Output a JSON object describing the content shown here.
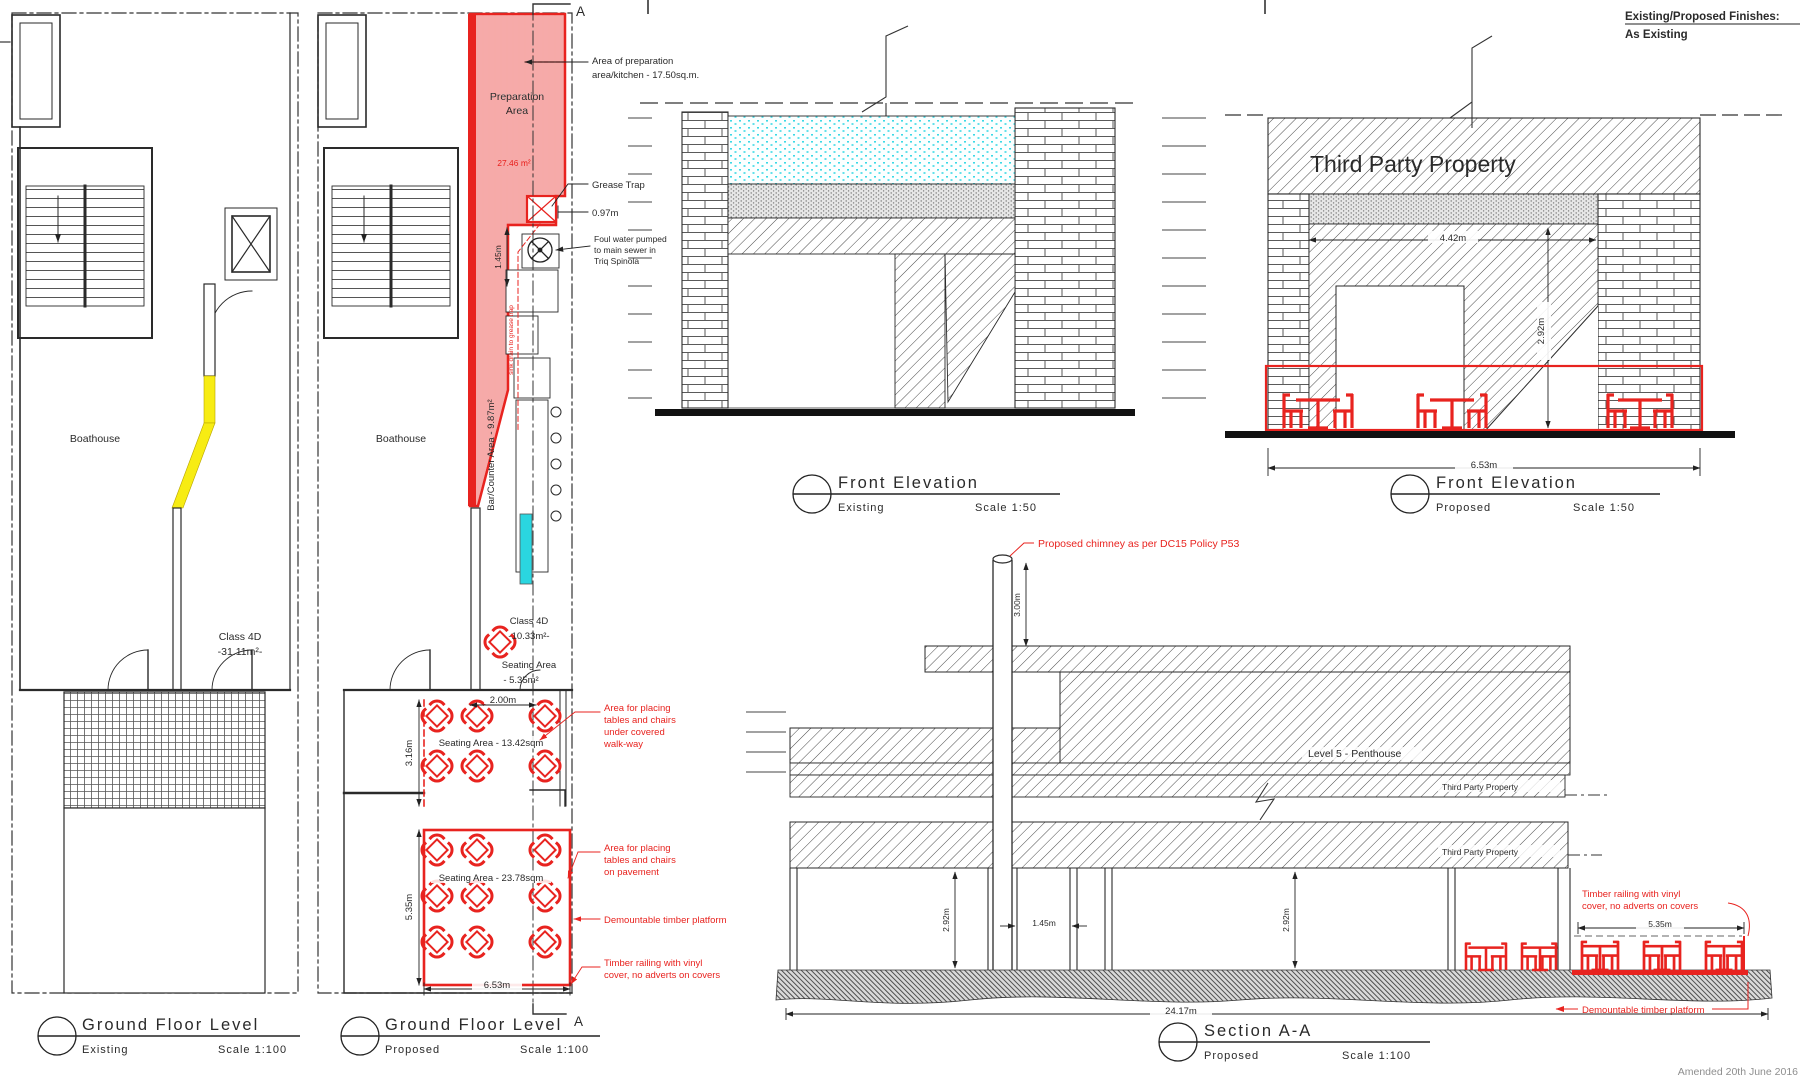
{
  "sheet": {
    "a_top": "A",
    "a_bottom": "A",
    "finishes_title": "Existing/Proposed  Finishes:",
    "finishes_value": "As  Existing",
    "amended": "Amended 20th June 2016",
    "accent_color": "#e8231f",
    "highlight_color": "#f7ec13",
    "counter_color": "#2ad6e0"
  },
  "plan_ex": {
    "boathouse": "Boathouse",
    "class4d": [
      "Class 4D",
      "-31.11m²-"
    ],
    "title": "Ground  Floor  Level",
    "sub": "Existing",
    "scale": "Scale  1:100"
  },
  "plan_pr": {
    "boathouse": "Boathouse",
    "prep": [
      "Preparation",
      "Area"
    ],
    "prep_area": "27.46 m²",
    "ann_prep": [
      "Area of preparation",
      "area/kitchen - 17.50sq.m."
    ],
    "grease": "Grease Trap",
    "d097": "0.97m",
    "foul": [
      "Foul water pumped",
      "to main sewer in",
      "Triq Spinola"
    ],
    "d145": "1.45m",
    "drain": "sink drain to grease trap",
    "bar": "Bar/Counter Area - 9.87m²",
    "class4d": [
      "Class 4D",
      "-10.33m²-"
    ],
    "seat_in": [
      "Seating Area",
      "- 5.35m²"
    ],
    "d200": "2.00m",
    "d316": "3.16m",
    "seat_walk": "Seating Area - 13.42sqm",
    "d535": "5.35m",
    "seat_pave": "Seating Area - 23.78sqm",
    "d653": "6.53m",
    "ann_walk": [
      "Area for placing",
      "tables and chairs",
      "under covered",
      "walk-way"
    ],
    "ann_pave": [
      "Area for placing",
      "tables and chairs",
      "on pavement"
    ],
    "ann_platform": "Demountable timber platform",
    "ann_rail": [
      "Timber railing with vinyl",
      "cover, no adverts on covers"
    ],
    "title": "Ground  Floor  Level",
    "sub": "Proposed",
    "scale": "Scale  1:100"
  },
  "elev_ex": {
    "title": "Front  Elevation",
    "sub": "Existing",
    "scale": "Scale  1:50"
  },
  "elev_pr": {
    "third_party": "Third Party Property",
    "dw": "4.42m",
    "dh": "2.92m",
    "d653": "6.53m",
    "title": "Front  Elevation",
    "sub": "Proposed",
    "scale": "Scale  1:50"
  },
  "section": {
    "chimney": "Proposed chimney as per DC15 Policy P53",
    "d300": "3.00m",
    "level5": "Level 5 - Penthouse",
    "tpp1": "Third Party Property",
    "tpp2": "Third Party Property",
    "d292a": "2.92m",
    "d145": "1.45m",
    "d292b": "2.92m",
    "d2417": "24.17m",
    "d535": "5.35m",
    "rail": [
      "Timber railing with vinyl",
      "cover, no adverts on covers"
    ],
    "platform": "Demountable timber platform",
    "title": "Section  A-A",
    "sub": "Proposed",
    "scale": "Scale  1:100"
  }
}
